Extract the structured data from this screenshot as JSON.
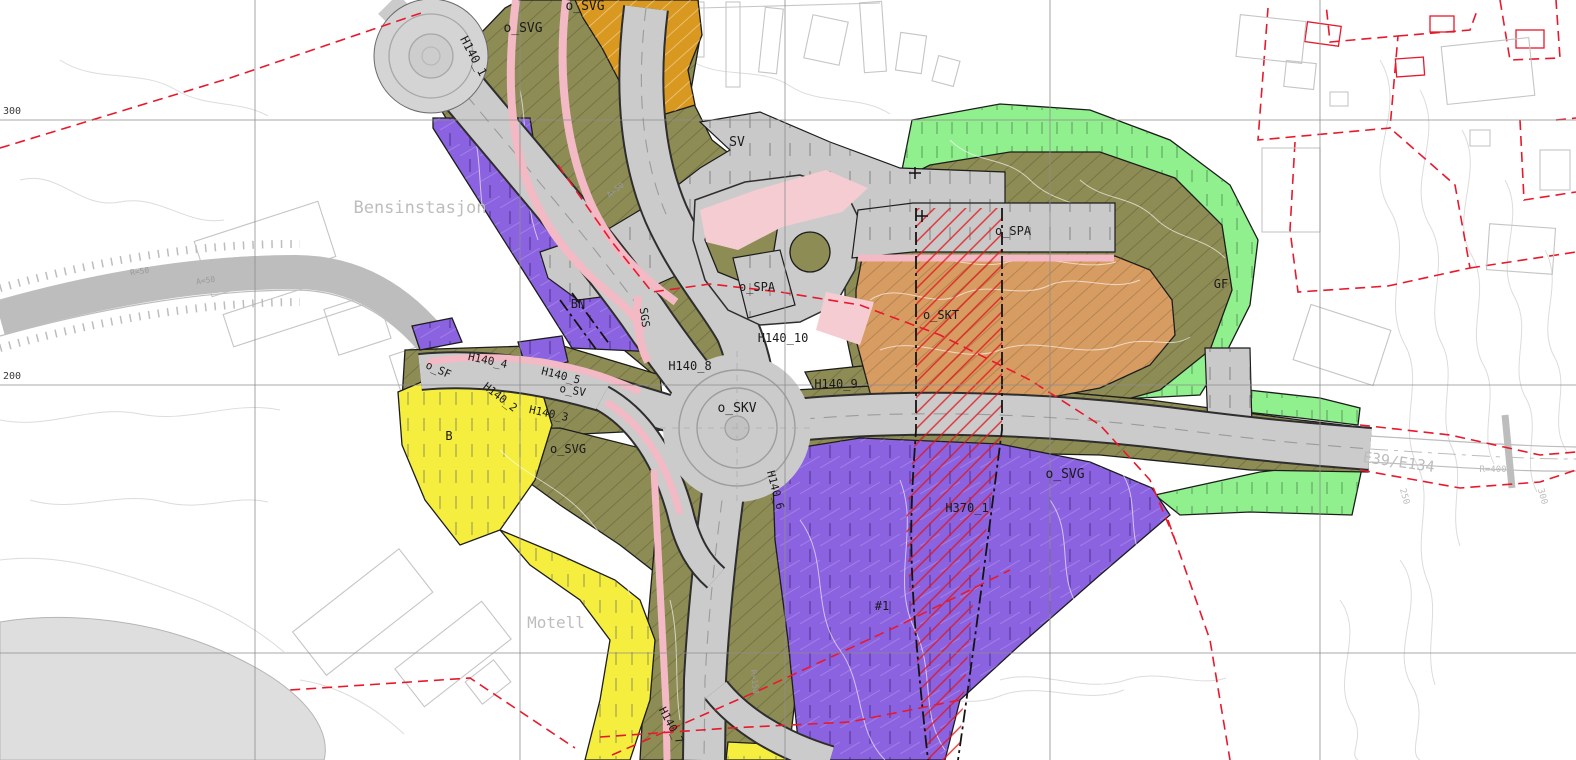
{
  "colors": {
    "purple": "#8b63e0",
    "yellow": "#f5ee3e",
    "green": "#8ff08d",
    "olive": "#8e8c55",
    "orange": "#d9981f",
    "skt": "#d79c62",
    "road": "#cbcbcb",
    "grayzone": "#c9c9c9",
    "pink": "#f3b9c4",
    "pinkarea": "#f6ccd3",
    "red": "#e8192c",
    "water": "#dedede"
  },
  "zone_codes": [
    "o_SVG",
    "SV",
    "o_SPA",
    "o_SKT",
    "o_SKV",
    "SGS",
    "o_SF",
    "o_SV",
    "BN",
    "B",
    "GF",
    "#1",
    "H140_1",
    "H140_2",
    "H140_3",
    "H140_4",
    "H140_5",
    "H140_6",
    "H140_7",
    "H140_8",
    "H140_9",
    "H140_10",
    "H370_1"
  ],
  "place_names": [
    "Bensinstasjon",
    "Motell"
  ],
  "road_refs": [
    "E39/E134",
    "R=400",
    "R=50",
    "A=50",
    "R=150"
  ],
  "grid_labels": [
    "300",
    "200"
  ],
  "labels": [
    {
      "t": "o_SVG",
      "x": 585,
      "y": 10,
      "r": 0,
      "c": "dark",
      "s": 13
    },
    {
      "t": "o_SVG",
      "x": 523,
      "y": 32,
      "r": 0,
      "c": "dark",
      "s": 13
    },
    {
      "t": "H140_1",
      "x": 470,
      "y": 58,
      "r": 62,
      "c": "dark",
      "s": 12
    },
    {
      "t": "SV",
      "x": 737,
      "y": 146,
      "r": 0,
      "c": "dark",
      "s": 13
    },
    {
      "t": "Bensinstasjon",
      "x": 420,
      "y": 213,
      "r": 0,
      "c": "gray",
      "s": 17
    },
    {
      "t": "BN",
      "x": 578,
      "y": 308,
      "r": 0,
      "c": "dark",
      "s": 12
    },
    {
      "t": "SGS",
      "x": 641,
      "y": 318,
      "r": 82,
      "c": "dark",
      "s": 11
    },
    {
      "t": "o_SPA",
      "x": 757,
      "y": 291,
      "r": 0,
      "c": "dark",
      "s": 12
    },
    {
      "t": "H140_10",
      "x": 783,
      "y": 342,
      "r": 0,
      "c": "dark",
      "s": 12
    },
    {
      "t": "H140_8",
      "x": 690,
      "y": 370,
      "r": 0,
      "c": "dark",
      "s": 12
    },
    {
      "t": "H140_9",
      "x": 836,
      "y": 388,
      "r": 0,
      "c": "dark",
      "s": 12
    },
    {
      "t": "o_SKV",
      "x": 737,
      "y": 412,
      "r": 0,
      "c": "dark",
      "s": 13
    },
    {
      "t": "o_SPA",
      "x": 1013,
      "y": 235,
      "r": 0,
      "c": "dark",
      "s": 12
    },
    {
      "t": "o_SKT",
      "x": 941,
      "y": 319,
      "r": 0,
      "c": "dark",
      "s": 12
    },
    {
      "t": "GF",
      "x": 1221,
      "y": 288,
      "r": 0,
      "c": "dark",
      "s": 12
    },
    {
      "t": "o_SVG",
      "x": 1065,
      "y": 478,
      "r": 0,
      "c": "dark",
      "s": 13
    },
    {
      "t": "H370_1",
      "x": 967,
      "y": 512,
      "r": 0,
      "c": "dark",
      "s": 12
    },
    {
      "t": "#1",
      "x": 882,
      "y": 610,
      "r": 0,
      "c": "dark",
      "s": 12
    },
    {
      "t": "B",
      "x": 449,
      "y": 440,
      "r": 0,
      "c": "dark",
      "s": 12
    },
    {
      "t": "o_SVG",
      "x": 568,
      "y": 453,
      "r": 0,
      "c": "dark",
      "s": 12
    },
    {
      "t": "o_SF",
      "x": 437,
      "y": 373,
      "r": 24,
      "c": "dark",
      "s": 11
    },
    {
      "t": "H140_4",
      "x": 487,
      "y": 364,
      "r": 12,
      "c": "dark",
      "s": 11
    },
    {
      "t": "H140_5",
      "x": 560,
      "y": 379,
      "r": 14,
      "c": "dark",
      "s": 11
    },
    {
      "t": "H140_2",
      "x": 498,
      "y": 400,
      "r": 38,
      "c": "dark",
      "s": 11
    },
    {
      "t": "H140_3",
      "x": 548,
      "y": 417,
      "r": 12,
      "c": "dark",
      "s": 11
    },
    {
      "t": "o_SV",
      "x": 572,
      "y": 394,
      "r": 10,
      "c": "dark",
      "s": 11
    },
    {
      "t": "H140_6",
      "x": 772,
      "y": 491,
      "r": 75,
      "c": "dark",
      "s": 11
    },
    {
      "t": "H140_7",
      "x": 668,
      "y": 727,
      "r": 62,
      "c": "dark",
      "s": 11
    },
    {
      "t": "Motell",
      "x": 556,
      "y": 628,
      "r": 0,
      "c": "gray",
      "s": 16
    },
    {
      "t": "E39/E134",
      "x": 1398,
      "y": 467,
      "r": 8,
      "c": "gray",
      "s": 15
    },
    {
      "t": "R=400",
      "x": 1493,
      "y": 472,
      "r": 0,
      "c": "gray",
      "s": 9
    },
    {
      "t": "250",
      "x": 1402,
      "y": 497,
      "r": 75,
      "c": "gray",
      "s": 9
    },
    {
      "t": "300",
      "x": 1540,
      "y": 497,
      "r": 75,
      "c": "gray",
      "s": 9
    },
    {
      "t": "300",
      "x": 3,
      "y": 114,
      "r": 0,
      "c": "grid",
      "s": 10,
      "a": "start"
    },
    {
      "t": "200",
      "x": 3,
      "y": 379,
      "r": 0,
      "c": "grid",
      "s": 10,
      "a": "start"
    },
    {
      "t": "R=50",
      "x": 140,
      "y": 274,
      "r": -8,
      "c": "faint",
      "s": 8
    },
    {
      "t": "A=50",
      "x": 206,
      "y": 283,
      "r": -8,
      "c": "faint",
      "s": 8
    },
    {
      "t": "A=50",
      "x": 617,
      "y": 192,
      "r": -38,
      "c": "faint",
      "s": 8
    },
    {
      "t": "R=150",
      "x": 752,
      "y": 682,
      "r": 85,
      "c": "faint",
      "s": 8
    }
  ]
}
